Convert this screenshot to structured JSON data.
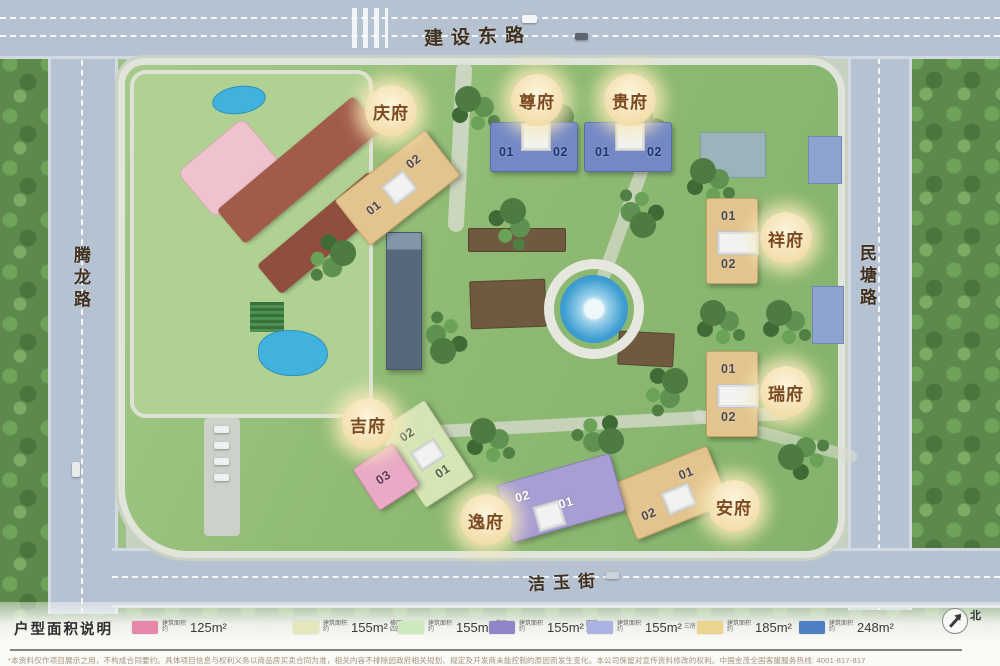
{
  "streets": {
    "top": "建设东路",
    "left": "腾龙路",
    "right": "民塘路",
    "bottom": "洁玉街"
  },
  "plots": [
    {
      "id": "qingfu",
      "label": "庆府",
      "units": [
        "01",
        "02"
      ]
    },
    {
      "id": "zunfu",
      "label": "尊府",
      "units": [
        "01",
        "02"
      ]
    },
    {
      "id": "guifu",
      "label": "贵府",
      "units": [
        "01",
        "02"
      ]
    },
    {
      "id": "xiangfu",
      "label": "祥府",
      "units": [
        "01",
        "02"
      ]
    },
    {
      "id": "ruifu",
      "label": "瑞府",
      "units": [
        "01",
        "02"
      ]
    },
    {
      "id": "anfu",
      "label": "安府",
      "units": [
        "01",
        "02"
      ]
    },
    {
      "id": "jifu",
      "label": "吉府",
      "units": [
        "02",
        "01",
        "03"
      ]
    },
    {
      "id": "yifu",
      "label": "逸府",
      "units": [
        "02",
        "01"
      ]
    }
  ],
  "compass": {
    "label": "北"
  },
  "legend": {
    "title": "户型面积说明",
    "items": [
      {
        "color": "#e887ac",
        "prefix": "建筑面积约",
        "area": "125m²",
        "note": ""
      },
      {
        "color": "#e5e7bd",
        "prefix": "建筑面积约",
        "area": "155m²",
        "note": "横厅\n四房"
      },
      {
        "color": "#cdeabf",
        "prefix": "建筑面积约",
        "area": "155m²",
        "note": "横厅\n边套"
      },
      {
        "color": "#8e86c9",
        "prefix": "建筑面积约",
        "area": "155m²",
        "note": "四房\n边套"
      },
      {
        "color": "#aab3e3",
        "prefix": "建筑面积约",
        "area": "155m²",
        "note": "三房"
      },
      {
        "color": "#ecd48e",
        "prefix": "建筑面积约",
        "area": "185m²",
        "note": ""
      },
      {
        "color": "#4e7fc3",
        "prefix": "建筑面积约",
        "area": "248m²",
        "note": ""
      }
    ]
  },
  "footer": {
    "disclaimer": "*本资料仅作项目展示之用，不构成合同要约。具体项目信息与权利义务以商品房买卖合同为准，相关内容不排除因政府相关规划、规定及开发商未能控制的原因而发生变化。本公司保留对宣传资料修改的权利。中国金茂全国客服服务热线: 4001-817-817"
  }
}
